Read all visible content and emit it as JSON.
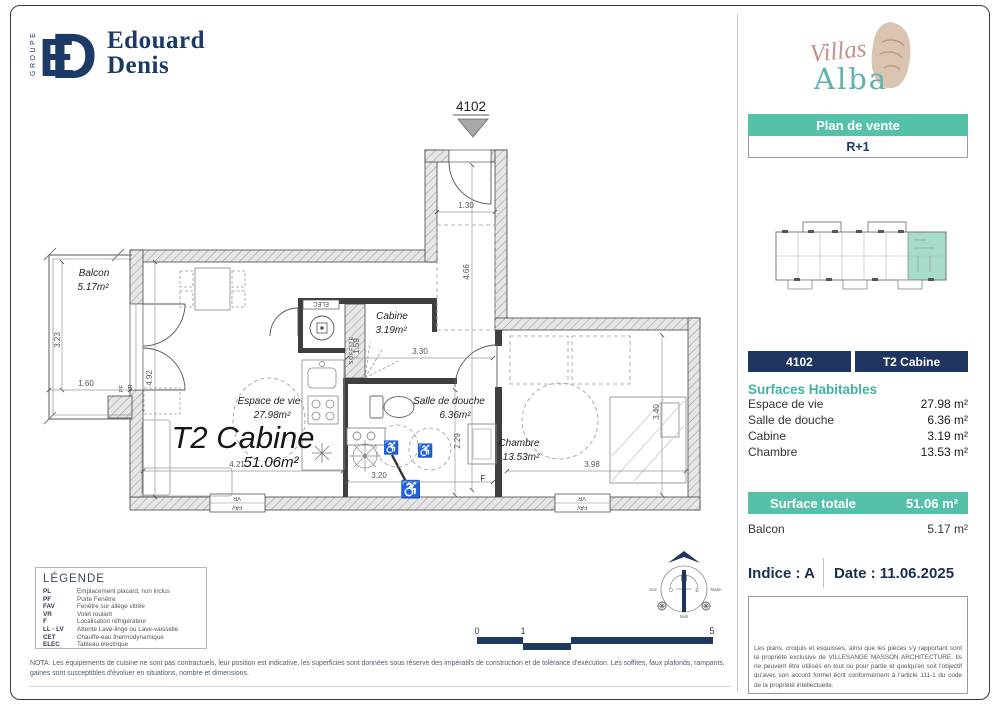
{
  "brand": {
    "groupe": "GROUPE",
    "monogram_e": "E",
    "monogram_d": "D",
    "name_line1": "Edouard",
    "name_line2": "Denis"
  },
  "side_panel": {
    "logo_villas": "Villas",
    "logo_alba": "Alba",
    "plan_de_vente": "Plan de vente",
    "level": "R+1",
    "unit_number": "4102",
    "unit_type": "T2 Cabine",
    "surfaces_title": "Surfaces Habitables",
    "surfaces": [
      {
        "label": "Espace de vie",
        "value": "27.98 m²"
      },
      {
        "label": "Salle de douche",
        "value": "6.36 m²"
      },
      {
        "label": "Cabine",
        "value": "3.19 m²"
      },
      {
        "label": "Chambre",
        "value": "13.53 m²"
      }
    ],
    "total_label": "Surface totale",
    "total_value": "51.06 m²",
    "balcon_label": "Balcon",
    "balcon_value": "5.17 m²",
    "indice": "Indice : A",
    "date": "Date : 11.06.2025",
    "copyright": "Les plans, croquis et esquisses, ainsi que les pièces s'y rapportant sont la propriété exclusive de VILLESANGE MASSON ARCHITECTURE. Ils ne peuvent être utilisés en tout ou pour partie et quelqu'en soit l'objectif qu'avec son accord formel écrit conformément à l'article 111-1 du code de la propriété intellectuelle."
  },
  "floor_plan": {
    "unit_marker": "4102",
    "main_label": {
      "title": "T2 Cabine",
      "area": "51.06m²"
    },
    "rooms": {
      "balcon": {
        "name": "Balcon",
        "area": "5.17m²"
      },
      "espace_de_vie": {
        "name": "Espace de vie",
        "area": "27.98m²"
      },
      "cabine": {
        "name": "Cabine",
        "area": "3.19m²"
      },
      "salle_de_douche": {
        "name": "Salle de douche",
        "area": "6.36m²"
      },
      "chambre": {
        "name": "Chambre",
        "area": "13.53m²"
      }
    },
    "dimensions": {
      "balcon_h": "3.23",
      "balcon_w": "1.60",
      "living_h": "4.92",
      "living_w": "4.21",
      "hall_w": "1.30",
      "hall_h": "4.66",
      "cabine_w": "3.30",
      "soffite_h": "1.59",
      "douche_w": "3.20",
      "douche_h": "2.29",
      "chambre_w": "3.98",
      "chambre_h": "3.40"
    },
    "annotations": {
      "pf": "PF",
      "vr": "VR",
      "fav": "FAV",
      "f": "F",
      "elec": "ELEC",
      "soffite": "SOFFITE"
    }
  },
  "icons": {
    "wheelchair": "♿"
  },
  "compass": {
    "n": "N",
    "o": "O",
    "e": "E",
    "soir": "Soir",
    "matin": "Matin",
    "midi": "Midi"
  },
  "scale_bar": {
    "t0": "0",
    "t1": "1",
    "t5": "5"
  },
  "legend": {
    "title": "LÉGENDE",
    "items": [
      {
        "abbr": "PL",
        "desc": "Emplacement placard, non inclus"
      },
      {
        "abbr": "PF",
        "desc": "Porte Fenêtre"
      },
      {
        "abbr": "FAV",
        "desc": "Fenêtre sur allège vitrée"
      },
      {
        "abbr": "VR",
        "desc": "Volet roulant"
      },
      {
        "abbr": "F",
        "desc": "Localisation réfrigérateur"
      },
      {
        "abbr": "LL - LV",
        "desc": "Attente Lave-linge ou Lave-vaisselle"
      },
      {
        "abbr": "CET",
        "desc": "Chauffe-eau thermodynamique"
      },
      {
        "abbr": "ELEC",
        "desc": "Tableau électrique"
      }
    ]
  },
  "nota": "NOTA: Les équipements de cuisine ne sont pas contractuels, leur position est indicative, les superficies sont données sous réserve des impératifs de construction et de tolérance d'exécution. Les soffites, faux plafonds, rampants, gaines sont susceptibles d'évoluer en situations, nombre et dimensions.",
  "colors": {
    "navy": "#1e3560",
    "teal": "#55c1a9",
    "teal_light": "#a7dbca",
    "rose": "#c4908a"
  }
}
